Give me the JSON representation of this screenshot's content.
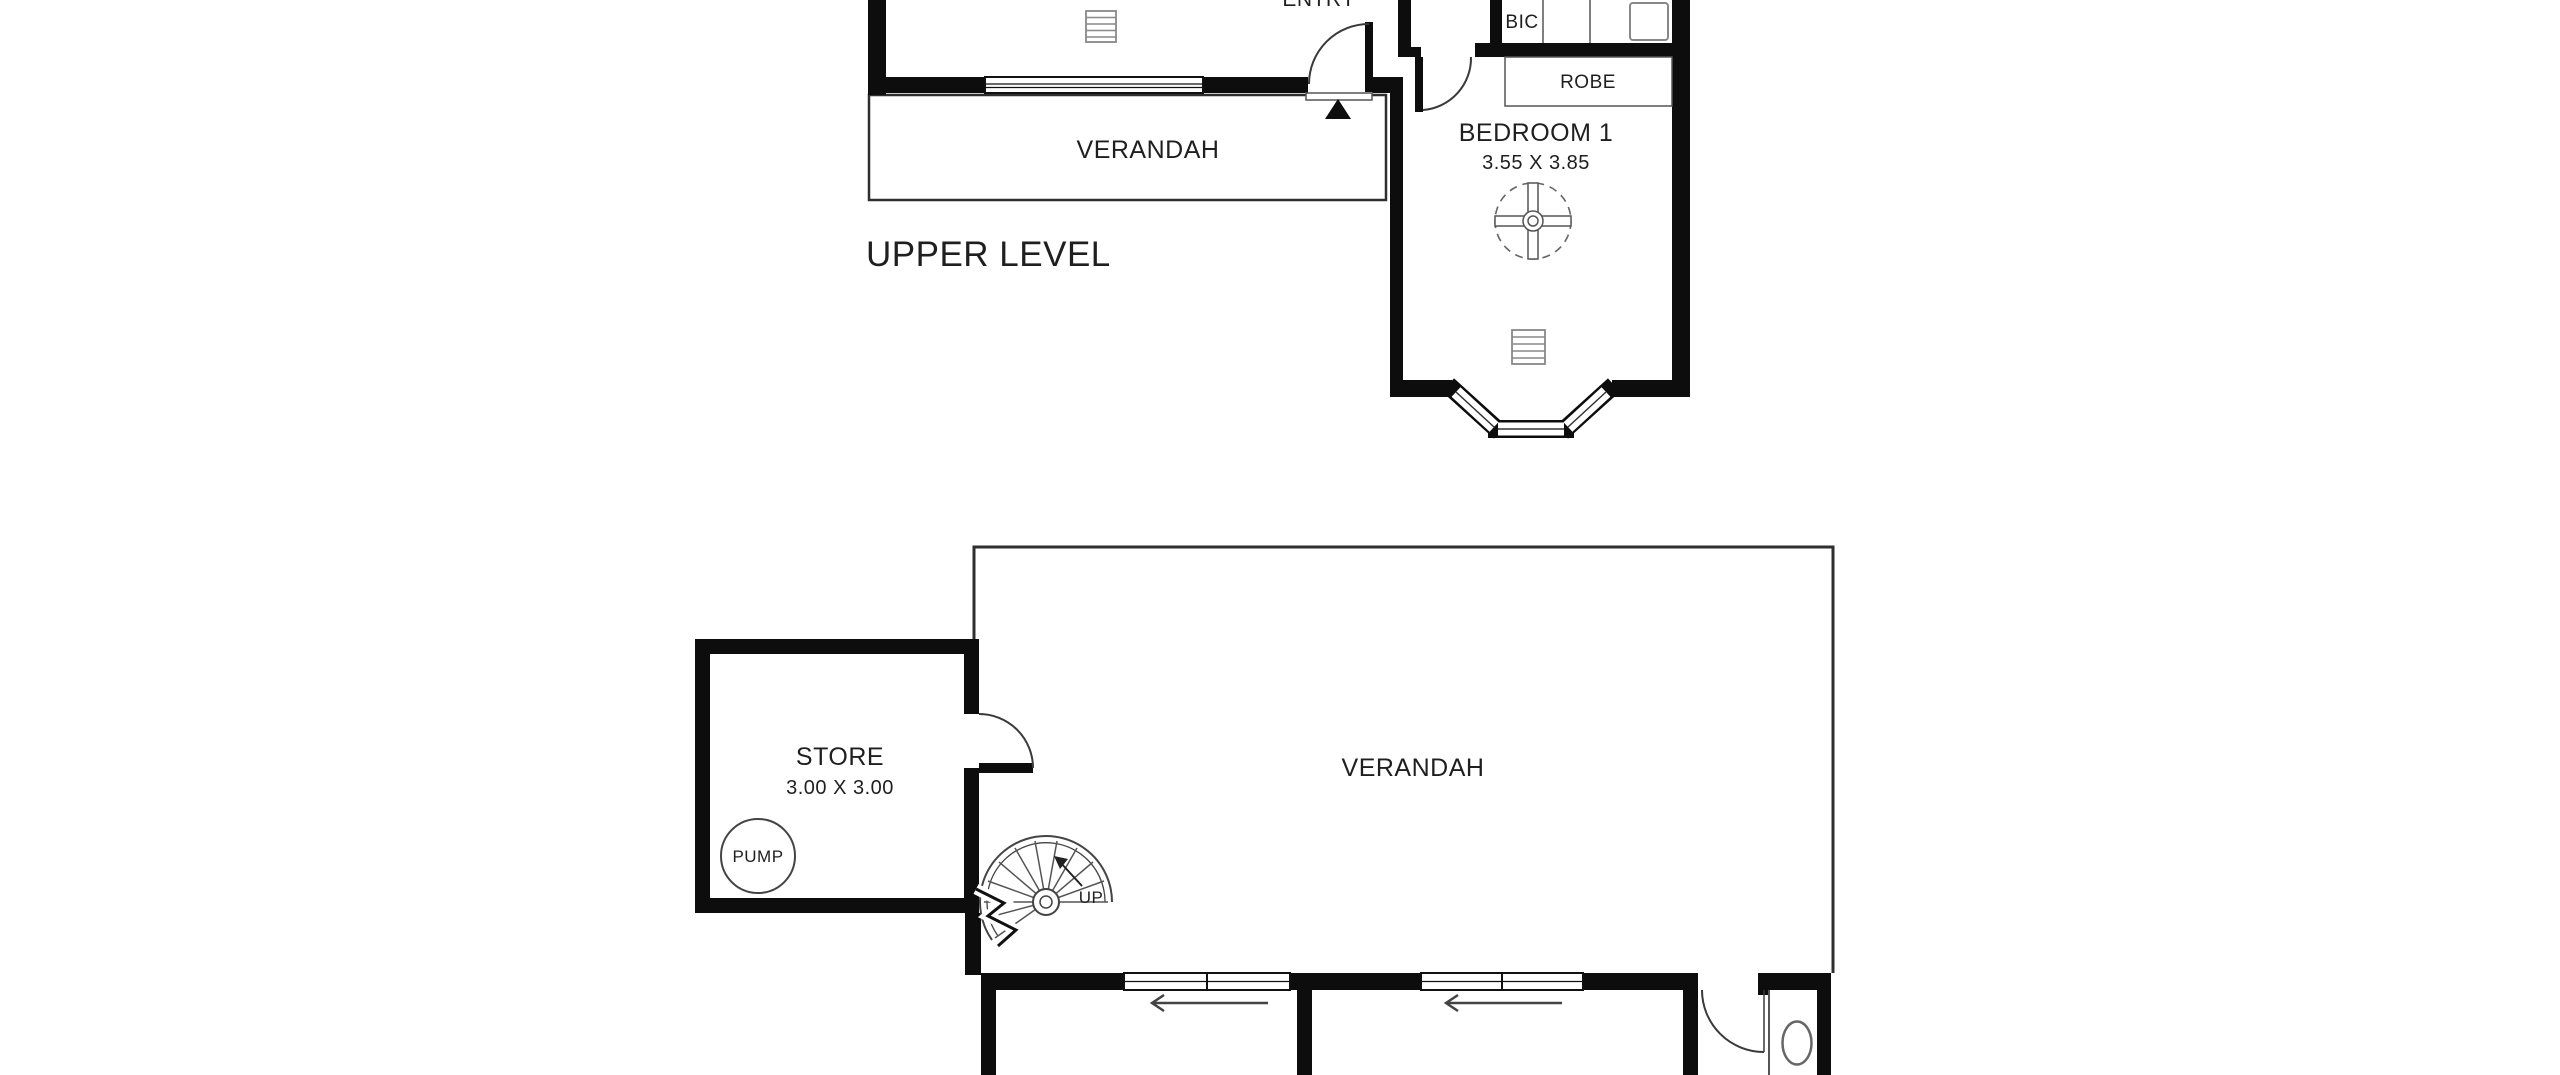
{
  "colors": {
    "background": "#ffffff",
    "wall": "#0d0d0d",
    "thin_line": "#555555",
    "text": "#1f1f1f"
  },
  "upper_level": {
    "section_label": "UPPER LEVEL",
    "rooms": {
      "entry": {
        "label": "ENTRY"
      },
      "verandah": {
        "label": "VERANDAH"
      },
      "bedroom1": {
        "label": "BEDROOM 1",
        "dimensions": "3.55 X 3.85"
      },
      "bic": {
        "label": "BIC"
      },
      "robe": {
        "label": "ROBE"
      }
    }
  },
  "lower_level": {
    "rooms": {
      "store": {
        "label": "STORE",
        "dimensions": "3.00 X 3.00"
      },
      "pump": {
        "label": "PUMP"
      },
      "verandah": {
        "label": "VERANDAH"
      },
      "stairs": {
        "label": "UP"
      }
    }
  }
}
